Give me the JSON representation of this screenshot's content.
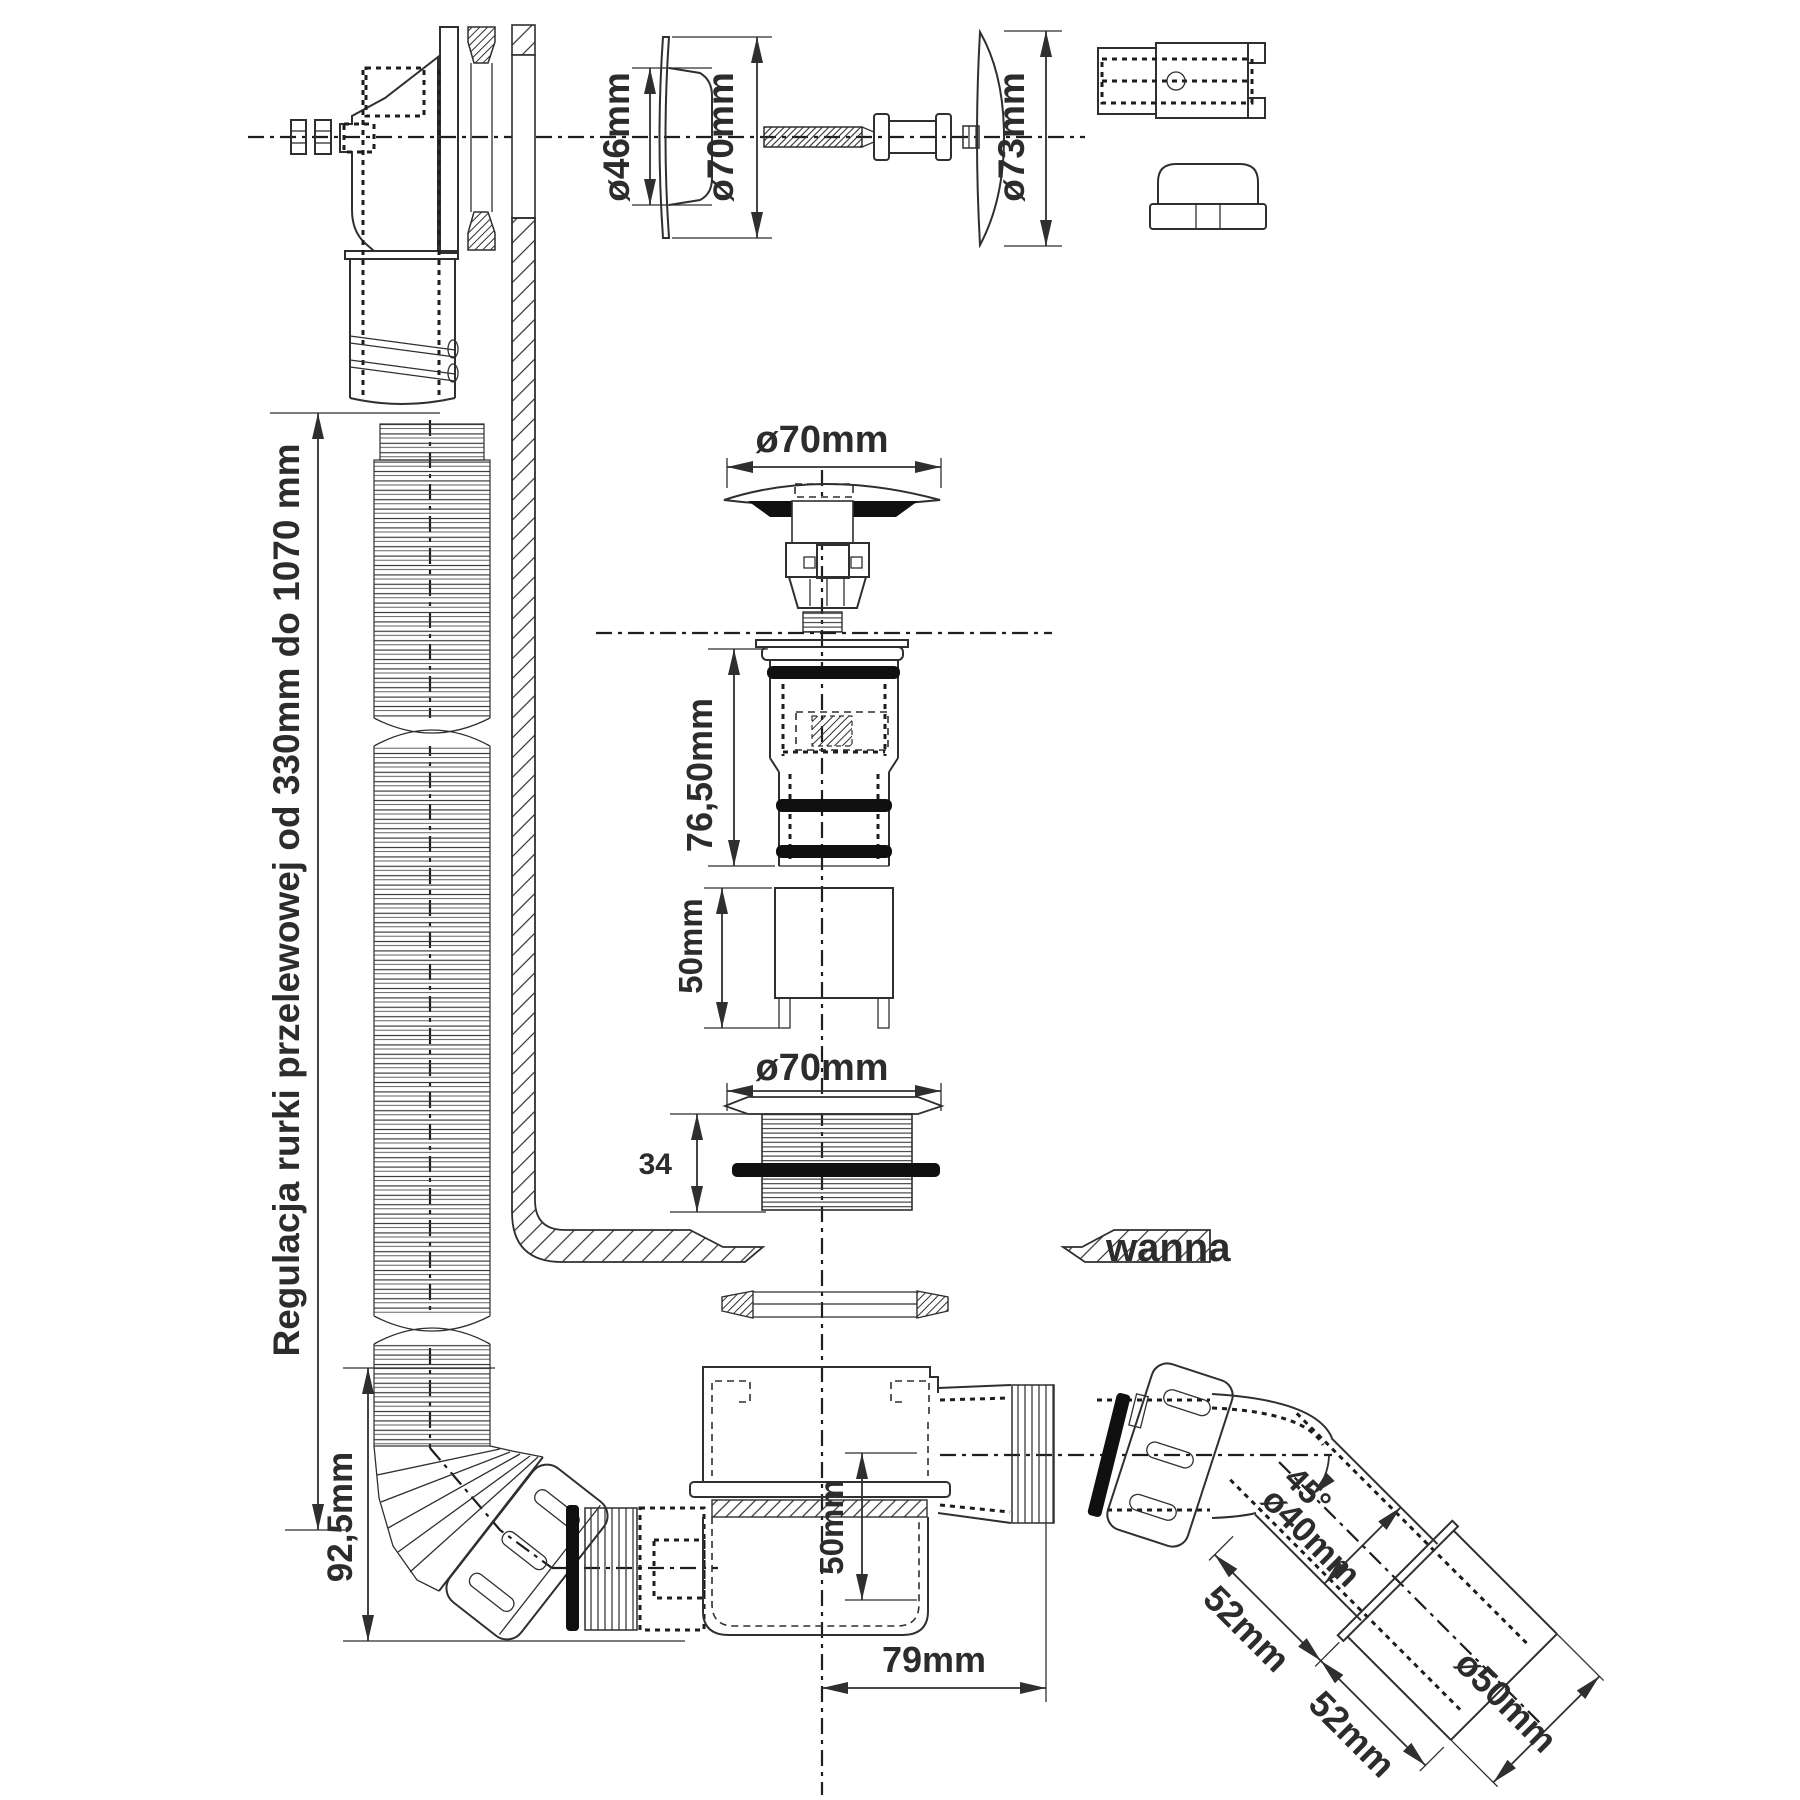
{
  "colors": {
    "line": "#2f2f2f",
    "text": "#2c2c2c",
    "black": "#101010",
    "background": "#ffffff"
  },
  "labels": {
    "overflow_cap_inner_diameter": "ø46mm",
    "overflow_cap_outer_diameter": "ø70mm",
    "overflow_cover_diameter": "ø73mm",
    "plug_diameter": "ø70mm",
    "drain_body_height": "76,50mm",
    "extension_tube_height": "50mm",
    "drain_flange_diameter": "ø70mm",
    "drain_flange_thread_height": "34",
    "overflow_adjustment_range": "Regulacja rurki przelewowej od  330mm do 1070 mm",
    "overflow_elbow_height": "92,5mm",
    "bathtub_label": "wanna",
    "trap_inlet_depth": "50mm",
    "trap_outlet_offset": "79mm",
    "elbow_angle": "45°",
    "elbow_pipe_diameter": "ø40mm",
    "elbow_segment_length": "52mm",
    "sleeve_segment_length": "52mm",
    "sleeve_diameter": "ø50mm"
  }
}
